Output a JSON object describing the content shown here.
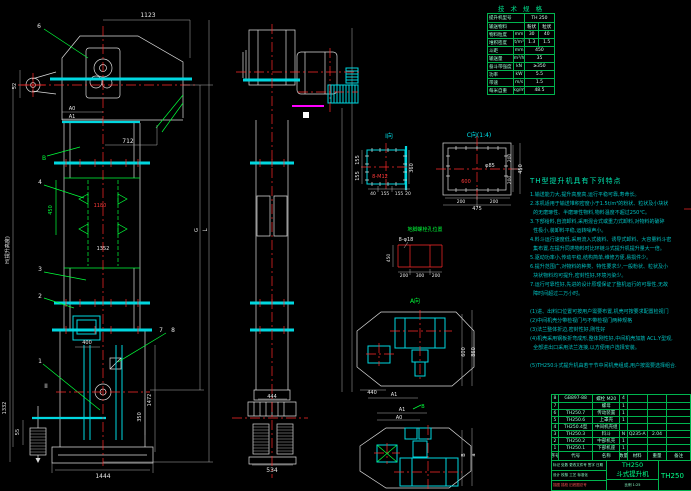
{
  "colors": {
    "background": "#000000",
    "cyan": "#00d7e0",
    "green": "#00ff3a",
    "red": "#ff2a2a",
    "white": "#e8e8e8",
    "magenta": "#ff00ff",
    "table_border_green": "#00b44e"
  },
  "spec_table": {
    "title": "技 术 规 格",
    "rows": [
      {
        "label": "提升机型号",
        "unit": "",
        "v1": "TH 250",
        "v2": ""
      },
      {
        "label": "输送物料",
        "unit": "",
        "v1": "粉状",
        "v2": "粒状"
      },
      {
        "label": "物料粒度",
        "unit": "mm",
        "v1": "30",
        "v2": "40"
      },
      {
        "label": "堆积密度",
        "unit": "t/m³",
        "v1": "1.3",
        "v2": "1.5"
      },
      {
        "label": "斗距",
        "unit": "mm",
        "v1": "450",
        "v2": ""
      },
      {
        "label": "输送量",
        "unit": "m³/h",
        "v1": "35",
        "v2": ""
      },
      {
        "label": "畚斗带强度",
        "unit": "kN",
        "v1": "≥350",
        "v2": ""
      },
      {
        "label": "功率",
        "unit": "kW",
        "v1": "5.5",
        "v2": ""
      },
      {
        "label": "带速",
        "unit": "m/s",
        "v1": "1.5",
        "v2": ""
      },
      {
        "label": "每米自重",
        "unit": "kg/m",
        "v1": "48.5",
        "v2": ""
      }
    ]
  },
  "features": {
    "title": "TH型提升机具有下列特点",
    "lines": [
      "1.输送能力大,提升高度高,运行平稳可靠,寿命长。",
      "2.本机适用于输送堆积密度小于1.5t/m³的粉状、粒状及小块状",
      "  的无磨琢性、半磨琢性物料,物料温度不超过250℃。",
      "3.下部给料,自流卸料,采用混合式或重力式卸料,对物料的破碎",
      "  性极小,装卸料平稳,运转噪声小。",
      "4.料斗运行速度低,采用流入式装料、诱导式卸料、大容量料斗密",
      "  集布置,在提升同类物料时比环链斗式提升机提升量大一倍。",
      "5.驱动功率小,传动平稳,结构简单,维修方便,易损件少。",
      "6.提升范围广,对物料的种类、特性要求少,一般粉状、粒状及小",
      "  块状物料均可提升,密封性好,环境污染少。",
      "7.运行可靠性好,先进的设计原理保证了整机运行的可靠性,无故",
      "  障时间超过二万小时。",
      "",
      "(1)进、出料口位置可按用户需要布置,机壳可按要求配置检视门",
      "(2)中间机壳分带检视门与不带检视门两种规格",
      "(3)法兰整体折边,密封性好,刚性好",
      "(4)机壳采用钢板折弯成形,整体刚性好,中间机壳加筋 ACL.Y型观,",
      "  全部进出口采用法兰连接,以方便用户选择安装。",
      "",
      "(5)TH250斗式提升机由若干节中间机壳组成,用户按需要选择组合."
    ]
  },
  "bom": {
    "header": [
      "序号",
      "代号",
      "名称",
      "数量",
      "材料",
      "重量",
      "备注"
    ],
    "rows": [
      [
        "8",
        "GB897-88",
        "螺栓 M20",
        "4",
        "",
        "",
        ""
      ],
      [
        "7",
        "",
        "螺母",
        "1",
        "",
        "",
        ""
      ],
      [
        "6",
        "TH250.7",
        "传动装置",
        "1",
        "",
        "",
        ""
      ],
      [
        "5",
        "TH250.6",
        "上罩壳",
        "1",
        "",
        "",
        ""
      ],
      [
        "4",
        "TH250.4型",
        "中间机壳组",
        "",
        "",
        "",
        ""
      ],
      [
        "3",
        "TH250.3",
        "料斗",
        "N",
        "Q235-A",
        "2.04",
        ""
      ],
      [
        "2",
        "TH250.2",
        "中部机壳",
        "1",
        "",
        "",
        ""
      ],
      [
        "1",
        "TH250.1",
        "下部机座",
        "1",
        "",
        "",
        ""
      ]
    ]
  },
  "title_block": {
    "model": "TH250",
    "product": "斗式提升机",
    "drawing_no": "TH250",
    "info_row": "比例 1:25",
    "left_rows": [
      {
        "t": "标记 处数 更改文件号 签字 日期",
        "c": "g"
      },
      {
        "t": "设计 校核 工艺 标准化",
        "c": "g"
      },
      {
        "t": "描图 描校 旧底图总号",
        "c": "r"
      }
    ]
  },
  "labels": [
    {
      "t": "1123",
      "x": 148,
      "y": 17
    },
    {
      "t": "6",
      "x": 39,
      "y": 28
    },
    {
      "t": "52",
      "x": 16,
      "y": 86,
      "s": 5,
      "r": -90
    },
    {
      "t": "A0",
      "x": 72,
      "y": 110,
      "s": 5
    },
    {
      "t": "A1",
      "x": 72,
      "y": 118,
      "s": 5
    },
    {
      "t": "712",
      "x": 128,
      "y": 143
    },
    {
      "t": "B",
      "x": 44,
      "y": 160,
      "c": "g"
    },
    {
      "t": "4",
      "x": 40,
      "y": 184
    },
    {
      "t": "450",
      "x": 52,
      "y": 210,
      "c": "g",
      "s": 5,
      "r": -90
    },
    {
      "t": "1180",
      "x": 100,
      "y": 207,
      "c": "r",
      "s": 5
    },
    {
      "t": "1352",
      "x": 103,
      "y": 250,
      "s": 5
    },
    {
      "t": "3",
      "x": 40,
      "y": 271
    },
    {
      "t": "2",
      "x": 40,
      "y": 298
    },
    {
      "t": "H(提升高度)",
      "x": 9,
      "y": 250,
      "s": 5,
      "r": -90
    },
    {
      "t": "G",
      "x": 198,
      "y": 230,
      "s": 5,
      "r": -90
    },
    {
      "t": "L",
      "x": 207,
      "y": 230,
      "r": -90
    },
    {
      "t": "7",
      "x": 161,
      "y": 332
    },
    {
      "t": "8",
      "x": 173,
      "y": 332
    },
    {
      "t": "400",
      "x": 87,
      "y": 344,
      "s": 5
    },
    {
      "t": "1",
      "x": 40,
      "y": 363
    },
    {
      "t": "II",
      "x": 46,
      "y": 388
    },
    {
      "t": "1472",
      "x": 151,
      "y": 400,
      "s": 5,
      "r": -90
    },
    {
      "t": "350",
      "x": 141,
      "y": 417,
      "s": 5,
      "r": -90
    },
    {
      "t": "1332",
      "x": 6,
      "y": 408,
      "s": 5,
      "r": -90
    },
    {
      "t": "55",
      "x": 19,
      "y": 432,
      "s": 5,
      "r": -90
    },
    {
      "t": "1444",
      "x": 103,
      "y": 478
    },
    {
      "t": "444",
      "x": 272,
      "y": 398,
      "s": 5
    },
    {
      "t": "534",
      "x": 272,
      "y": 472
    },
    {
      "t": "I向",
      "x": 389,
      "y": 138,
      "c": "c"
    },
    {
      "t": "8-M12",
      "x": 380,
      "y": 178,
      "c": "r",
      "s": 5
    },
    {
      "t": "360",
      "x": 413,
      "y": 168,
      "s": 5,
      "r": -90
    },
    {
      "t": "155",
      "x": 359,
      "y": 160,
      "s": 5,
      "r": -90
    },
    {
      "t": "155",
      "x": 359,
      "y": 176,
      "s": 5,
      "r": -90
    },
    {
      "t": "40",
      "x": 373,
      "y": 195,
      "s": 4.5
    },
    {
      "t": "155",
      "x": 385,
      "y": 195,
      "s": 4.5
    },
    {
      "t": "155",
      "x": 399,
      "y": 195,
      "s": 4.5
    },
    {
      "t": "20",
      "x": 408,
      "y": 195,
      "s": 4.5
    },
    {
      "t": "C向(1:4)",
      "x": 479,
      "y": 137,
      "c": "c"
    },
    {
      "t": "φ85",
      "x": 490,
      "y": 167,
      "s": 5
    },
    {
      "t": "600",
      "x": 466,
      "y": 183,
      "c": "r",
      "s": 5
    },
    {
      "t": "200",
      "x": 461,
      "y": 203,
      "s": 4.5
    },
    {
      "t": "200",
      "x": 494,
      "y": 203,
      "s": 4.5
    },
    {
      "t": "475",
      "x": 477,
      "y": 210,
      "s": 5
    },
    {
      "t": "200",
      "x": 511,
      "y": 158,
      "s": 4.5,
      "r": -90
    },
    {
      "t": "200",
      "x": 511,
      "y": 180,
      "s": 4.5,
      "r": -90
    },
    {
      "t": "450",
      "x": 522,
      "y": 169,
      "s": 5,
      "r": -90
    },
    {
      "t": "地脚螺栓孔位置",
      "x": 425,
      "y": 231,
      "c": "g",
      "s": 5
    },
    {
      "t": "8-φ18",
      "x": 406,
      "y": 241,
      "s": 5
    },
    {
      "t": "450",
      "x": 390,
      "y": 258,
      "s": 4.5,
      "r": -90
    },
    {
      "t": "200",
      "x": 404,
      "y": 277,
      "s": 4.5
    },
    {
      "t": "300",
      "x": 420,
      "y": 277,
      "s": 4.5
    },
    {
      "t": "200",
      "x": 436,
      "y": 277,
      "s": 4.5
    },
    {
      "t": "A向",
      "x": 415,
      "y": 303,
      "c": "g"
    },
    {
      "t": "600",
      "x": 465,
      "y": 352,
      "s": 5,
      "r": -90
    },
    {
      "t": "860",
      "x": 475,
      "y": 352,
      "s": 5,
      "r": -90
    },
    {
      "t": "440",
      "x": 372,
      "y": 394,
      "s": 5
    },
    {
      "t": "A1",
      "x": 394,
      "y": 396,
      "s": 5
    },
    {
      "t": "A1",
      "x": 402,
      "y": 411,
      "s": 5
    },
    {
      "t": "A0",
      "x": 399,
      "y": 419,
      "s": 5
    },
    {
      "t": "B",
      "x": 423,
      "y": 408,
      "c": "g",
      "s": 5
    },
    {
      "t": "B",
      "x": 465,
      "y": 455,
      "s": 5,
      "r": -90
    },
    {
      "t": "a",
      "x": 475,
      "y": 455,
      "s": 5,
      "r": -90
    }
  ]
}
